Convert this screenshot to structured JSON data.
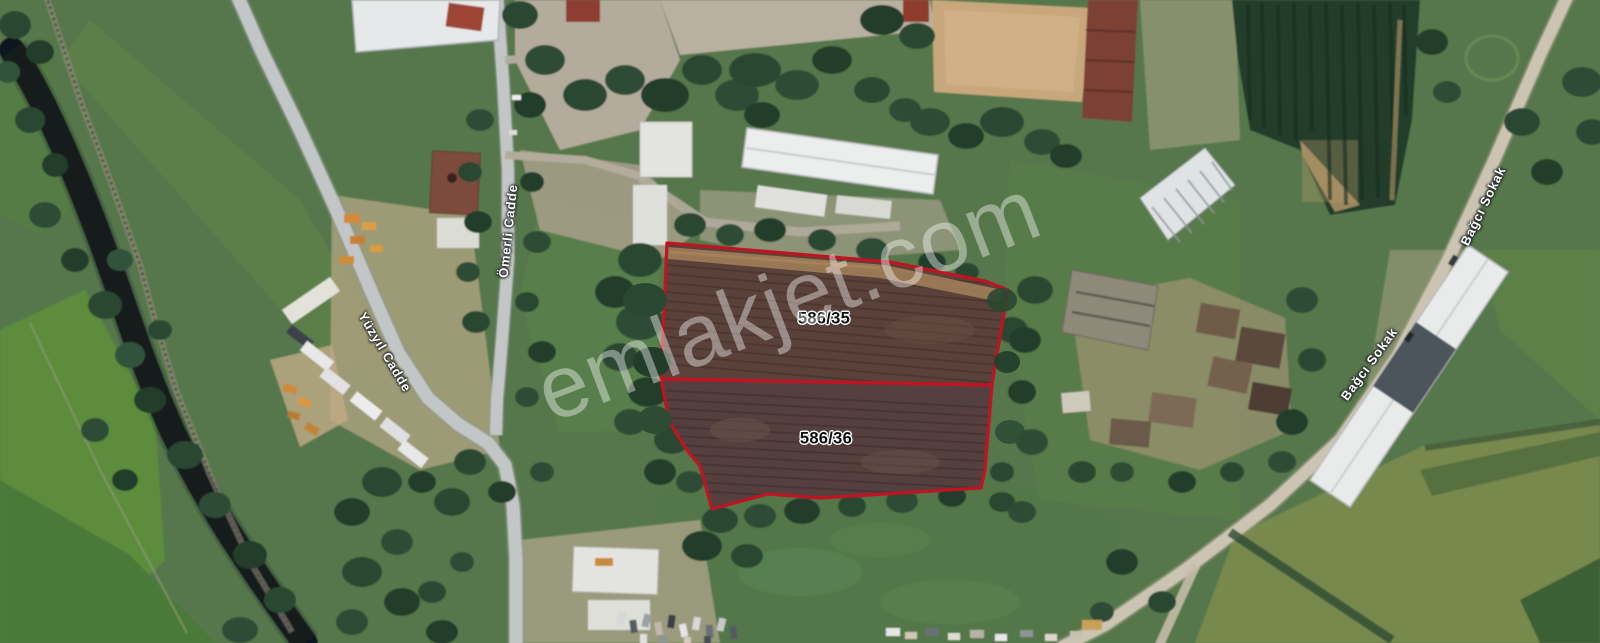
{
  "map": {
    "watermark": "emlakjet.com",
    "parcels": [
      {
        "label": "586/35",
        "points": "667,243 890,262 985,281 1008,290 996,360 992,385 661,379"
      },
      {
        "label": "586/36",
        "points": "661,379 992,385 985,470 981,488 820,498 768,494 712,509 700,466 686,449 669,421"
      }
    ],
    "divider_points": "661,379 992,385",
    "road_labels": [
      {
        "name": "Ömerli Cadde"
      },
      {
        "name": "Yüzyıl Cadde"
      },
      {
        "name": "Bağcı Sokak"
      },
      {
        "name": "Bağcı Sokak"
      }
    ],
    "colors": {
      "parcel_outline": "#bf1422",
      "parcel_fill_upper": "#5a423a",
      "parcel_fill_lower": "#55403f",
      "road_label_text": "#ffffff",
      "parcel_label_text": "#0b0b0b",
      "watermark_text": "rgba(255,255,255,0.40)"
    }
  }
}
